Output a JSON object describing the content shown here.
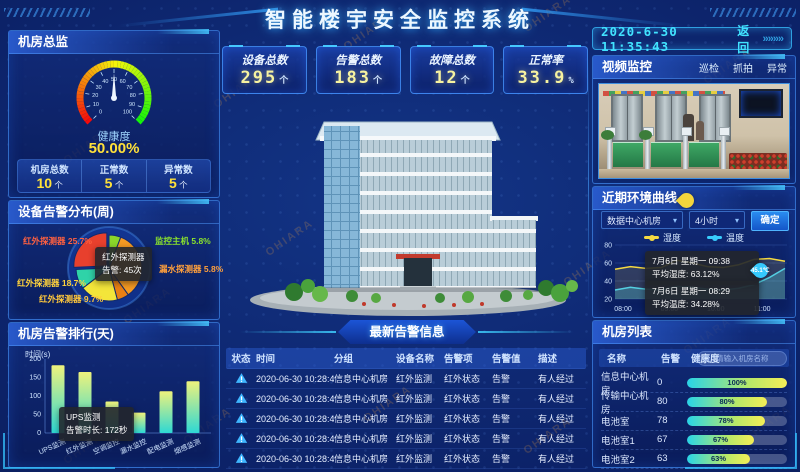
{
  "watermark": "OHIARA",
  "header": {
    "title": "智能楼宇安全监控系统"
  },
  "topbar": {
    "datetime": "2020-6-30 11:35:43",
    "back_label": "返回",
    "back_arrows": "»»»»"
  },
  "stats": [
    {
      "label": "设备总数",
      "value": "295",
      "unit": "个"
    },
    {
      "label": "告警总数",
      "value": "183",
      "unit": "个"
    },
    {
      "label": "故障总数",
      "value": "12",
      "unit": "个"
    },
    {
      "label": "正常率",
      "value": "33.9",
      "unit": "%"
    }
  ],
  "room_overview": {
    "title": "机房总监",
    "gauge_label": "健康度",
    "gauge_value": "50.00%",
    "metrics": [
      {
        "label": "机房总数",
        "value": "10",
        "unit": "个"
      },
      {
        "label": "正常数",
        "value": "5",
        "unit": "个"
      },
      {
        "label": "异常数",
        "value": "5",
        "unit": "个"
      }
    ]
  },
  "alarm_distribution": {
    "title": "设备告警分布(周)",
    "labels": [
      {
        "text": "红外探测器 25.7%",
        "color": "#ff6040"
      },
      {
        "text": "监控主机 5.8%",
        "color": "#8be32c"
      },
      {
        "text": "漏水探测器 5.8%",
        "color": "#ffa03c"
      },
      {
        "text": "红外探测器 18.7%",
        "color": "#ffd23c"
      },
      {
        "text": "红外探测器 9.7%",
        "color": "#ffc83c"
      }
    ],
    "tooltip": {
      "line1": "红外探测器",
      "line2": "告警: 45次"
    }
  },
  "alarm_ranking": {
    "title": "机房告警排行(天)",
    "y_axis_label": "时间(s)",
    "tooltip": {
      "line1": "UPS监测",
      "line2": "告警时长: 172秒"
    }
  },
  "video": {
    "title": "视频监控",
    "tabs": [
      "巡检",
      "抓拍",
      "异常"
    ]
  },
  "env_curve": {
    "title": "近期环境曲线",
    "room_select": "数据中心机房",
    "period_select": "4小时",
    "confirm_label": "确定",
    "tooltips": [
      {
        "date": "7月6日 星期一 09:38",
        "value": "平均湿度: 63.12%"
      },
      {
        "date": "7月6日 星期一 08:29",
        "value": "平均温度: 34.28%"
      }
    ],
    "pin_label": "45.1℃"
  },
  "room_list": {
    "title": "机房列表",
    "headers": [
      "名称",
      "告警",
      "健康度"
    ],
    "search_placeholder": "请输入机房名称",
    "rows": [
      {
        "name": "信息中心机房",
        "alarms": "0",
        "health": 100
      },
      {
        "name": "传输中心机房",
        "alarms": "80",
        "health": 80
      },
      {
        "name": "电池室",
        "alarms": "78",
        "health": 78
      },
      {
        "name": "电池室1",
        "alarms": "67",
        "health": 67
      },
      {
        "name": "电池室2",
        "alarms": "63",
        "health": 63
      }
    ]
  },
  "alarm_info": {
    "title": "最新告警信息",
    "headers": [
      "状态",
      "时间",
      "分组",
      "设备名称",
      "告警项",
      "告警值",
      "描述"
    ],
    "rows": [
      {
        "time": "2020-06-30 10:28:48",
        "group": "信息中心机房",
        "device": "红外监测",
        "item": "红外状态",
        "value": "告警",
        "desc": "有人经过"
      },
      {
        "time": "2020-06-30 10:28:48",
        "group": "信息中心机房",
        "device": "红外监测",
        "item": "红外状态",
        "value": "告警",
        "desc": "有人经过"
      },
      {
        "time": "2020-06-30 10:28:48",
        "group": "信息中心机房",
        "device": "红外监测",
        "item": "红外状态",
        "value": "告警",
        "desc": "有人经过"
      },
      {
        "time": "2020-06-30 10:28:48",
        "group": "信息中心机房",
        "device": "红外监测",
        "item": "红外状态",
        "value": "告警",
        "desc": "有人经过"
      },
      {
        "time": "2020-06-30 10:28:48",
        "group": "信息中心机房",
        "device": "红外监测",
        "item": "红外状态",
        "value": "告警",
        "desc": "有人经过"
      }
    ]
  },
  "chart_data": [
    {
      "id": "health_gauge",
      "type": "gauge",
      "min": 0,
      "max": 100,
      "value": 50,
      "ticks": [
        0,
        10,
        20,
        30,
        40,
        50,
        60,
        70,
        80,
        90,
        100
      ],
      "label": "健康度",
      "display": "50.00%"
    },
    {
      "id": "device_alarm_pie",
      "type": "pie",
      "title": "设备告警分布(周)",
      "series": [
        {
          "name": "监控主机",
          "value": 5.8,
          "color": "#8bd62a"
        },
        {
          "name": "红外探测器",
          "value": 34.3,
          "color": "#f59a23"
        },
        {
          "name": "漏水探测器",
          "value": 5.8,
          "color": "#e97f14"
        },
        {
          "name": "红外探测器",
          "value": 18.7,
          "color": "#f3e53a"
        },
        {
          "name": "红外探测器",
          "value": 9.7,
          "color": "#2fd3a8"
        },
        {
          "name": "红外探测器",
          "value": 25.7,
          "color": "#e8402d"
        }
      ]
    },
    {
      "id": "room_alarm_bar",
      "type": "bar",
      "title": "机房告警排行(天)",
      "ylabel": "时间(s)",
      "ylim": [
        0,
        200
      ],
      "yticks": [
        0,
        50,
        100,
        150,
        200
      ],
      "categories": [
        "UPS监测",
        "红外监测",
        "空调监控",
        "漏水监控",
        "配电监测",
        "烟感监测"
      ],
      "values": [
        183,
        165,
        85,
        55,
        113,
        140
      ]
    },
    {
      "id": "env_line",
      "type": "line",
      "title": "近期环境曲线",
      "ylim": [
        20,
        80
      ],
      "yticks": [
        20,
        40,
        60,
        80
      ],
      "x_ticks": [
        "08:00",
        "09:00",
        "10:00",
        "11:00"
      ],
      "series": [
        {
          "name": "湿度",
          "color": "#f5d942",
          "values": [
            53,
            56,
            54,
            55,
            63,
            60,
            56,
            55,
            58,
            64,
            65,
            62
          ]
        },
        {
          "name": "温度",
          "color": "#38cdfd",
          "values": [
            30,
            33,
            31,
            30,
            34,
            33,
            31,
            30,
            32,
            36,
            44,
            54
          ]
        }
      ]
    }
  ]
}
